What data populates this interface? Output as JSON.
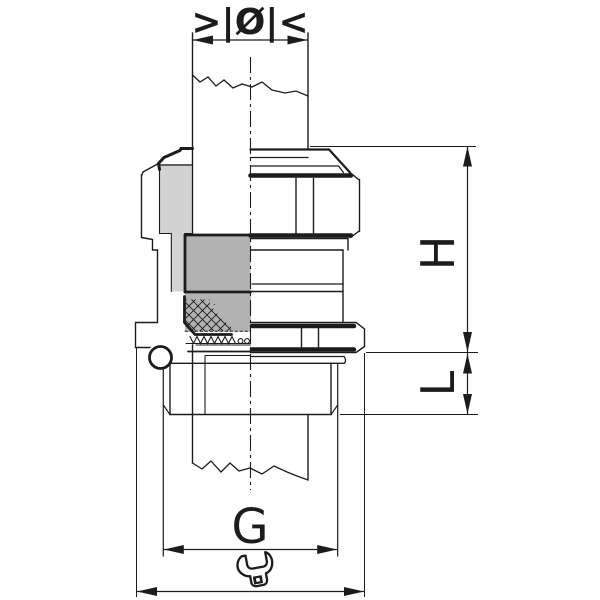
{
  "drawing": {
    "kind": "cable-gland-half-section-technical-drawing"
  },
  "labels": {
    "clamping_range_symbol": ">|Ø|<",
    "height_dim": "H",
    "thread_length_dim": "L",
    "thread_size_dim": "G"
  },
  "icons": {
    "wrench": "wrench-icon",
    "clamping_range": "clamping-range-symbol",
    "centerline": "center-line"
  },
  "colors": {
    "line": "#1c1c1c",
    "section_light": "#d2d2d2",
    "section_medium": "#b2b2b2",
    "background": "#ffffff"
  }
}
